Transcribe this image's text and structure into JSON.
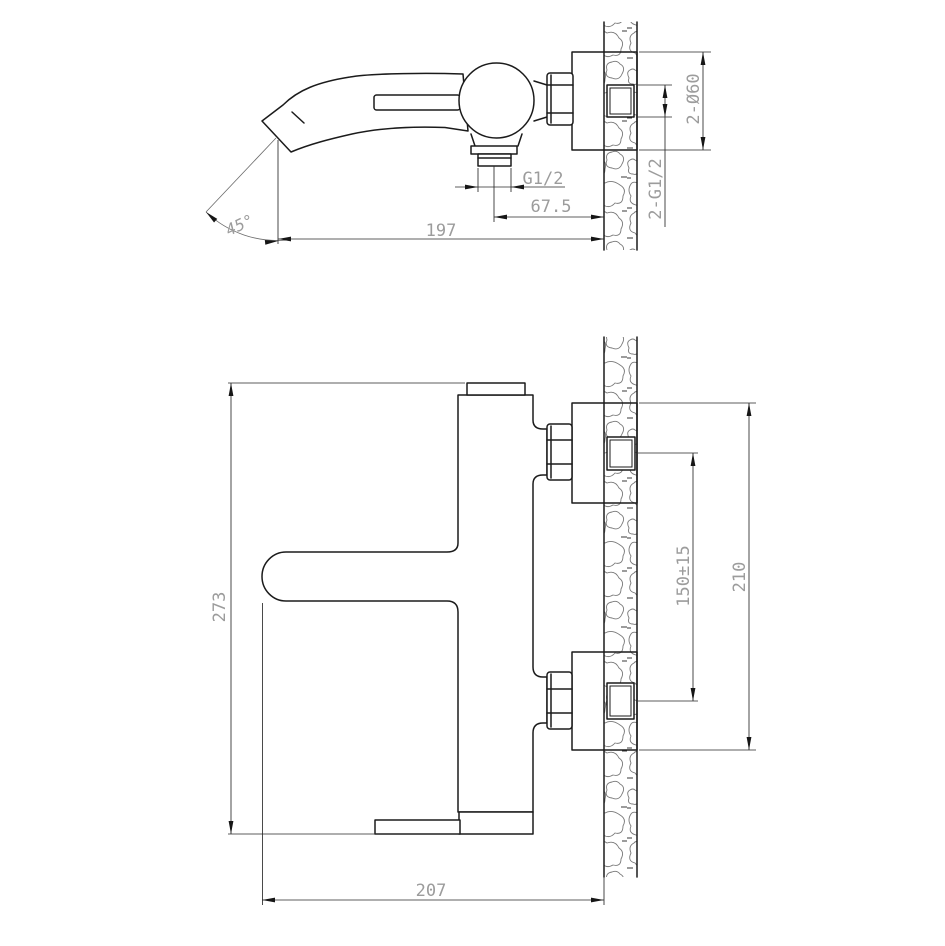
{
  "meta": {
    "background": "#ffffff",
    "line_color": "#1b1b1b",
    "dim_text_color": "#9c9c9c",
    "wall_hatch_color": "#787878"
  },
  "side_view": {
    "dims": {
      "spout_angle": "45°",
      "spout_reach": "197",
      "outlet_offset": "67.5",
      "outlet_thread": "G1/2",
      "escutcheons": "2-Ø60",
      "inlet_threads": "2-G1/2"
    }
  },
  "front_view": {
    "dims": {
      "total_height": "273",
      "total_reach": "207",
      "inlet_spacing": "150±15",
      "plate_span": "210"
    }
  }
}
